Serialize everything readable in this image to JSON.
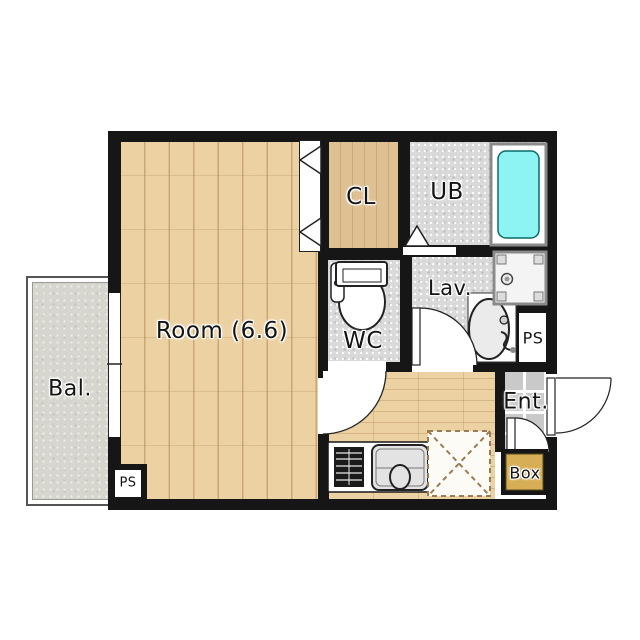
{
  "floorplan": {
    "labels": {
      "room": "Room (6.6)",
      "balcony": "Bal.",
      "closet": "CL",
      "unit_bath": "UB",
      "wc": "WC",
      "lavatory": "Lav.",
      "pipe_space_right": "PS",
      "entrance": "Ent.",
      "shoe_box": "Box",
      "pipe_space_left": "PS"
    },
    "colors": {
      "wall": "#161616",
      "wood_floor": "#ecd1a2",
      "closet_floor": "#dfc092",
      "wet_area_floor": "#d9d9d9",
      "balcony_floor": "#d6d5ce",
      "bathtub": "#8df3f3",
      "entrance_tile": "#c9c9c9",
      "box": "#d7ae55"
    }
  }
}
